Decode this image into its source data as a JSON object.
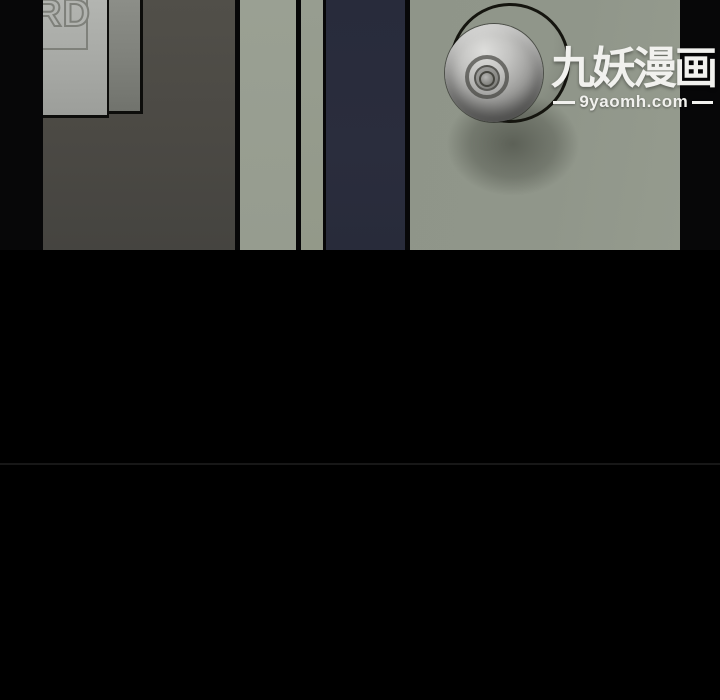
{
  "watermark": {
    "title": "九妖漫画",
    "site": "9yaomh.com"
  },
  "panel_door": {
    "sign_text": "RD"
  },
  "colors": {
    "page_bg": "#000000",
    "wall": "#4b4944",
    "door_front_sign": "#aab0a8",
    "door_side": "#80827c",
    "door_jamb": "#979d90",
    "door_edge_navy": "#282b3b",
    "door_main": "#8f9589",
    "knob_metal_light": "#dededc",
    "knob_metal_dark": "#565654",
    "outline_ink": "#15150f",
    "watermark_text": "#f1f1ee",
    "panel_divider": "#171717"
  }
}
